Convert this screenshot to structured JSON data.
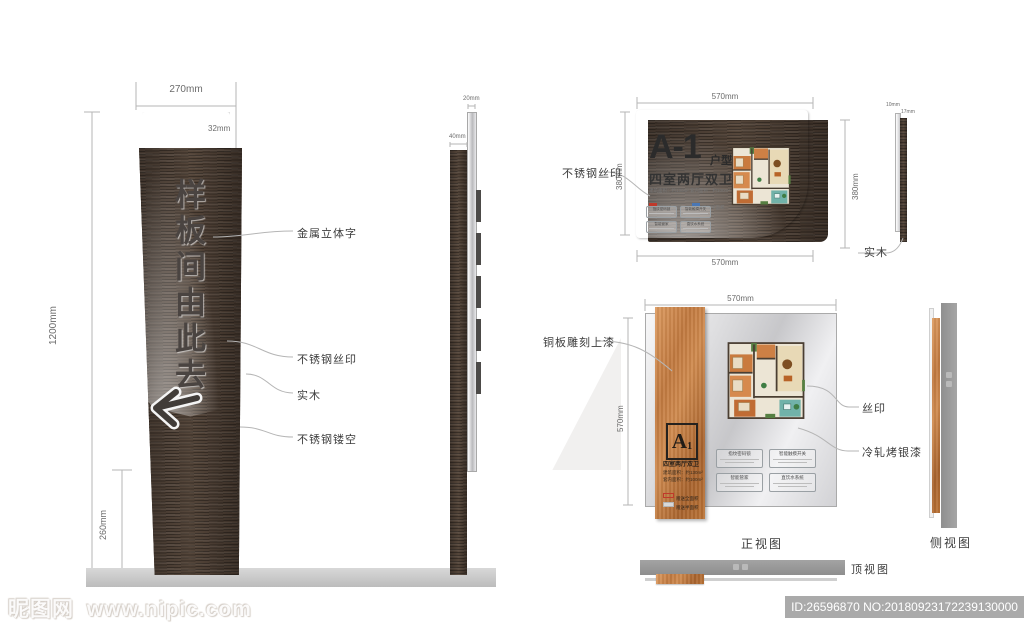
{
  "colors": {
    "copper": "#c27a40",
    "dark_wood": "#473a30",
    "silver_panel": "#d9d9db",
    "legend_red": "#c0392b",
    "legend_blue": "#4a77b4",
    "ground_gray": "#c6c6c6"
  },
  "totem_front": {
    "sign_text": "样板间由此去",
    "arrow_icon": "left-arrow",
    "dim_width": "270mm",
    "dim_top_offset": "32mm",
    "dim_height": "1200mm",
    "dim_base": "260mm",
    "callouts": {
      "metal_letters": "金属立体字",
      "silkscreen": "不锈钢丝印",
      "wood": "实木",
      "hollow": "不锈钢镂空"
    }
  },
  "totem_side": {
    "dim_plate": "20mm",
    "dim_wood": "40mm"
  },
  "plaque": {
    "unit_code": "A-1",
    "unit_label": "户型",
    "subtitle": "四室两厅双卫",
    "area_line": "建筑面积：约130m²  套内面积：约100m²",
    "dim_top": "570mm",
    "dim_bottom": "570mm",
    "dim_left": "380mm",
    "dim_right": "380mm",
    "callout_face": "不锈钢丝印",
    "callout_back": "实木",
    "side_dim_plate": "10mm",
    "side_dim_wood": "17mm"
  },
  "panel2": {
    "unit_letter": "A",
    "unit_number": "1",
    "subtitle": "四室两厅双卫",
    "area_line1": "建筑面积：约130m²",
    "area_line2": "套内面积：约100m²",
    "dim_top": "570mm",
    "dim_left": "570mm",
    "callout_copper": "铜板雕刻上漆",
    "callout_silk": "丝印",
    "callout_paint": "冷轧烤银漆"
  },
  "features": [
    {
      "title": "指纹密码锁"
    },
    {
      "title": "智能触摸开关"
    },
    {
      "title": "智能管家"
    },
    {
      "title": "直饮水系统"
    }
  ],
  "legend": [
    {
      "label": "赠送全面积"
    },
    {
      "label": "赠送半面积"
    }
  ],
  "views": {
    "front": "正视图",
    "side": "侧视图",
    "top": "顶视图"
  },
  "watermark": {
    "site_name": "昵图网",
    "site_url": "www.nipic.com",
    "id_text": "ID:26596870 NO:20180923172239130000"
  }
}
